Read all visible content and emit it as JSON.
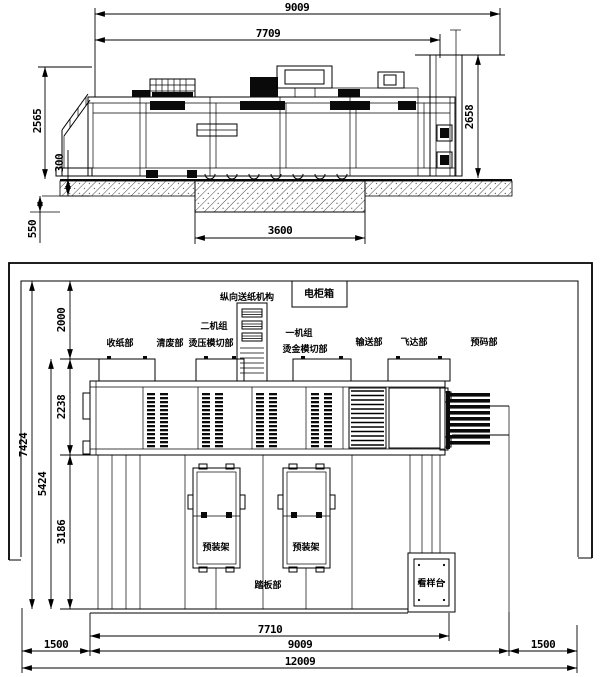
{
  "top_view": {
    "dims": {
      "overall_width": "9009",
      "upper_width": "7709",
      "machine_height": "2565",
      "floor_thickness": "300",
      "pit_depth": "550",
      "pit_width": "3600",
      "feeder_height": "2658"
    }
  },
  "plan_view": {
    "labels": {
      "vertical_feeder": "纵向送纸机构",
      "electric_cabinet": "电柜箱",
      "delivery": "收纸部",
      "stripping": "清废部",
      "unit2": "二机组",
      "unit2_sub": "烫压模切部",
      "unit1": "一机组",
      "unit1_sub": "烫金模切部",
      "conveyor": "输送部",
      "feeder": "飞达部",
      "prestack": "预码部",
      "preload_rack_1": "预装架",
      "preload_rack_2": "预装架",
      "footboard": "踏板部",
      "sample_table": "看样台"
    },
    "dims": {
      "rear_clearance": "2000",
      "machine_depth": "2238",
      "front_depth": "3186",
      "sub_total_depth": "5424",
      "total_depth": "7424",
      "body_length": "7710",
      "machine_length": "9009",
      "left_clearance": "1500",
      "right_clearance": "1500",
      "overall_length": "12009"
    }
  }
}
